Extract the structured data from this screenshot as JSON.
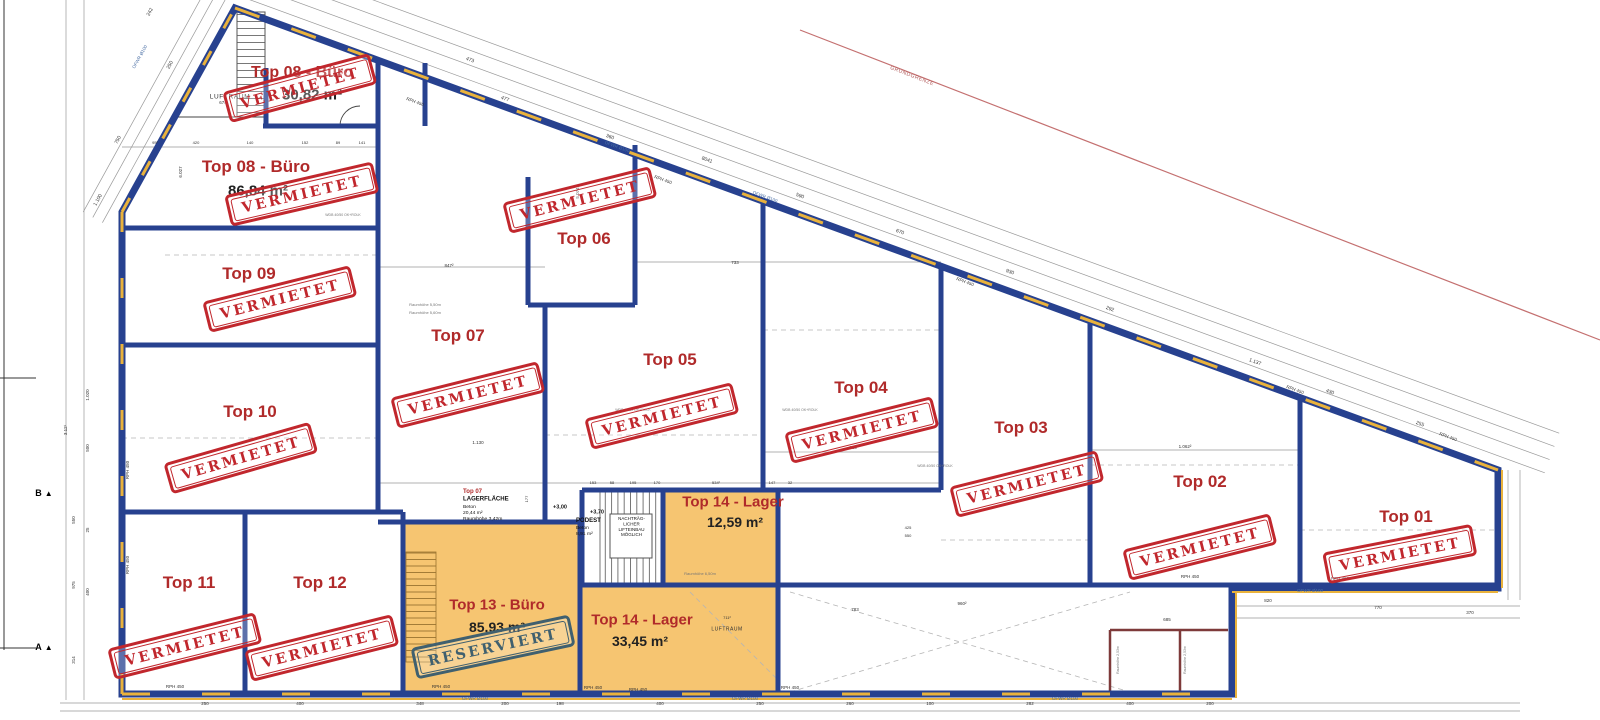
{
  "colors": {
    "wall_navy": "#27418f",
    "accent_gold": "#e9b23c",
    "highlight_orange": "#f6c571",
    "label_red": "#b02a2a",
    "stamp_red": "#c1272d",
    "stamp_slate": "#40606f",
    "boundary_red": "#c47070",
    "partition_maroon": "#7e3a3a"
  },
  "stamps": {
    "rented": "VERMIETET",
    "reserved": "RESERVIERT"
  },
  "units": {
    "top01": {
      "name": "Top 01",
      "status": "rented"
    },
    "top02": {
      "name": "Top 02",
      "status": "rented"
    },
    "top03": {
      "name": "Top 03",
      "status": "rented"
    },
    "top04": {
      "name": "Top 04",
      "status": "rented"
    },
    "top05": {
      "name": "Top 05",
      "status": "rented"
    },
    "top06": {
      "name": "Top 06",
      "status": "rented"
    },
    "top07": {
      "name": "Top 07",
      "status": "rented"
    },
    "top08_upper": {
      "name": "Top 08 - Büro",
      "area": "30,82 m²",
      "status": "rented"
    },
    "top08_lower": {
      "name": "Top 08 - Büro",
      "area": "86,84 m²",
      "status": "rented"
    },
    "top09": {
      "name": "Top 09",
      "status": "rented"
    },
    "top10": {
      "name": "Top 10",
      "status": "rented"
    },
    "top11": {
      "name": "Top 11",
      "status": "rented"
    },
    "top12": {
      "name": "Top 12",
      "status": "rented"
    },
    "top13": {
      "name": "Top 13 - Büro",
      "area": "85,93 m²",
      "status": "reserved"
    },
    "top14_upper": {
      "name": "Top 14 - Lager",
      "area": "12,59 m²",
      "status": ""
    },
    "top14_lower": {
      "name": "Top 14 - Lager",
      "area": "33,45 m²",
      "status": ""
    }
  },
  "annotations": {
    "luftraum": "LUFTRAUM",
    "storage_block": {
      "unit": "Top 07",
      "title": "LAGERFLÄCHE",
      "material": "Beton",
      "area": "20,44 m²",
      "room_height": "Raumhöhe 3,42m"
    },
    "podest_block": {
      "title": "PODEST",
      "material": "Beton",
      "area": "8,91 m²"
    },
    "lift_note_lines": [
      "NACHTRÄG-",
      "LICHER",
      "LIFTEINBAU",
      "MÖGLICH"
    ],
    "boundary_label": "GRUNDGRENZE",
    "section_markers": {
      "a": "A",
      "b": "B"
    },
    "levels": {
      "lower": "+3,00",
      "upper": "+3,70"
    }
  },
  "tiny_labels": [
    {
      "t": "473",
      "x": 470,
      "y": 60,
      "r": 20,
      "s": 5
    },
    {
      "t": "477",
      "x": 505,
      "y": 99,
      "r": 20,
      "s": 5
    },
    {
      "t": "360",
      "x": 610,
      "y": 137,
      "r": 20,
      "s": 5
    },
    {
      "t": "8041",
      "x": 707,
      "y": 160,
      "r": 20,
      "s": 5
    },
    {
      "t": "590",
      "x": 800,
      "y": 196,
      "r": 20,
      "s": 5
    },
    {
      "t": "670",
      "x": 900,
      "y": 232,
      "r": 20,
      "s": 5
    },
    {
      "t": "930",
      "x": 1010,
      "y": 272,
      "r": 20,
      "s": 5
    },
    {
      "t": "292",
      "x": 1110,
      "y": 309,
      "r": 20,
      "s": 5
    },
    {
      "t": "1.137",
      "x": 1255,
      "y": 362,
      "r": 20,
      "s": 5
    },
    {
      "t": "430",
      "x": 1330,
      "y": 392,
      "r": 20,
      "s": 5
    },
    {
      "t": "255",
      "x": 1420,
      "y": 424,
      "r": 20,
      "s": 5
    },
    {
      "t": "1.100",
      "x": 98,
      "y": 200,
      "r": -61,
      "s": 5
    },
    {
      "t": "750",
      "x": 118,
      "y": 140,
      "r": -61,
      "s": 5
    },
    {
      "t": "250",
      "x": 170,
      "y": 65,
      "r": -61,
      "s": 5
    },
    {
      "t": "242",
      "x": 150,
      "y": 12,
      "r": -61,
      "s": 5
    },
    {
      "t": "RPH 450",
      "x": 415,
      "y": 102,
      "r": 20,
      "s": 4.5
    },
    {
      "t": "RPH 450",
      "x": 663,
      "y": 180,
      "r": 20,
      "s": 4.5
    },
    {
      "t": "RPH 450",
      "x": 965,
      "y": 282,
      "r": 20,
      "s": 4.5
    },
    {
      "t": "RPH 450",
      "x": 1295,
      "y": 390,
      "r": 20,
      "s": 4.5
    },
    {
      "t": "RPH 450",
      "x": 1448,
      "y": 437,
      "r": 20,
      "s": 4.5
    },
    {
      "t": "RPH 450",
      "x": 128,
      "y": 470,
      "r": -90,
      "s": 4.5
    },
    {
      "t": "RPH 450",
      "x": 128,
      "y": 565,
      "r": -90,
      "s": 4.5
    },
    {
      "t": "RPH 450",
      "x": 175,
      "y": 687,
      "r": 0,
      "s": 4.5
    },
    {
      "t": "RPH 450",
      "x": 441,
      "y": 687,
      "r": 0,
      "s": 4.5
    },
    {
      "t": "RPH 450",
      "x": 593,
      "y": 688,
      "r": 0,
      "s": 4.5
    },
    {
      "t": "RPH 450",
      "x": 638,
      "y": 690,
      "r": 0,
      "s": 4.5
    },
    {
      "t": "RPH 450",
      "x": 790,
      "y": 688,
      "r": 0,
      "s": 4.5
    },
    {
      "t": "RPH 450",
      "x": 1190,
      "y": 577,
      "r": 0,
      "s": 4.5
    },
    {
      "t": "RPH 450",
      "x": 1340,
      "y": 579,
      "r": 0,
      "s": 4.5
    },
    {
      "t": "OFWR Ø100",
      "x": 475,
      "y": 699,
      "r": 0,
      "s": 4.5,
      "c": "blue"
    },
    {
      "t": "OFWR Ø100",
      "x": 745,
      "y": 699,
      "r": 0,
      "s": 4.5,
      "c": "blue"
    },
    {
      "t": "OFWR Ø100",
      "x": 1065,
      "y": 699,
      "r": 0,
      "s": 4.5,
      "c": "blue"
    },
    {
      "t": "OFWR Ø100",
      "x": 1310,
      "y": 591,
      "r": 0,
      "s": 4.5,
      "c": "blue"
    },
    {
      "t": "OFWR Ø100",
      "x": 140,
      "y": 57,
      "r": -61,
      "s": 4.5,
      "c": "blue"
    },
    {
      "t": "OFWR Ø100",
      "x": 617,
      "y": 147,
      "r": 20,
      "s": 4.5,
      "c": "blue"
    },
    {
      "t": "OFWR Ø100",
      "x": 765,
      "y": 197,
      "r": 20,
      "s": 4.5,
      "c": "blue"
    },
    {
      "t": "95²",
      "x": 155,
      "y": 143,
      "r": 0,
      "s": 4
    },
    {
      "t": "420",
      "x": 196,
      "y": 143,
      "r": 0,
      "s": 4
    },
    {
      "t": "140",
      "x": 250,
      "y": 143,
      "r": 0,
      "s": 4
    },
    {
      "t": "152",
      "x": 305,
      "y": 143,
      "r": 0,
      "s": 4
    },
    {
      "t": "89",
      "x": 338,
      "y": 143,
      "r": 0,
      "s": 4
    },
    {
      "t": "141",
      "x": 362,
      "y": 143,
      "r": 0,
      "s": 4
    },
    {
      "t": "153",
      "x": 593,
      "y": 483,
      "r": 0,
      "s": 4
    },
    {
      "t": "58",
      "x": 612,
      "y": 483,
      "r": 0,
      "s": 4
    },
    {
      "t": "195",
      "x": 633,
      "y": 483,
      "r": 0,
      "s": 4
    },
    {
      "t": "170",
      "x": 657,
      "y": 483,
      "r": 0,
      "s": 4
    },
    {
      "t": "534²",
      "x": 716,
      "y": 483,
      "r": 0,
      "s": 4
    },
    {
      "t": "147",
      "x": 772,
      "y": 483,
      "r": 0,
      "s": 4
    },
    {
      "t": "32",
      "x": 790,
      "y": 483,
      "r": 0,
      "s": 4
    },
    {
      "t": "674",
      "x": 223,
      "y": 103,
      "r": 0,
      "s": 4.5
    },
    {
      "t": "847²",
      "x": 449,
      "y": 266,
      "r": 0,
      "s": 4.5
    },
    {
      "t": "733",
      "x": 735,
      "y": 263,
      "r": 0,
      "s": 4.5
    },
    {
      "t": "5.074",
      "x": 578,
      "y": 193,
      "r": -90,
      "s": 4.5
    },
    {
      "t": "6.027",
      "x": 181,
      "y": 172,
      "r": -90,
      "s": 4.5
    },
    {
      "t": "1.130",
      "x": 478,
      "y": 443,
      "r": 0,
      "s": 4.5
    },
    {
      "t": "1.062²",
      "x": 1185,
      "y": 447,
      "r": 0,
      "s": 4.5
    },
    {
      "t": "960",
      "x": 853,
      "y": 448,
      "r": 0,
      "s": 4.5
    },
    {
      "t": "685",
      "x": 1167,
      "y": 620,
      "r": 0,
      "s": 4.5
    },
    {
      "t": "783",
      "x": 855,
      "y": 610,
      "r": 0,
      "s": 4.5
    },
    {
      "t": "960²",
      "x": 962,
      "y": 604,
      "r": 0,
      "s": 4.5
    },
    {
      "t": "711²",
      "x": 727,
      "y": 618,
      "r": 0,
      "s": 4
    },
    {
      "t": "425",
      "x": 908,
      "y": 528,
      "r": 0,
      "s": 4
    },
    {
      "t": "550",
      "x": 908,
      "y": 536,
      "r": 0,
      "s": 4
    },
    {
      "t": "177",
      "x": 527,
      "y": 499,
      "r": -90,
      "s": 4
    },
    {
      "t": "250",
      "x": 205,
      "y": 704,
      "r": 0,
      "s": 4.5
    },
    {
      "t": "400",
      "x": 300,
      "y": 704,
      "r": 0,
      "s": 4.5
    },
    {
      "t": "348",
      "x": 420,
      "y": 704,
      "r": 0,
      "s": 4.5
    },
    {
      "t": "200",
      "x": 505,
      "y": 704,
      "r": 0,
      "s": 4.5
    },
    {
      "t": "198",
      "x": 560,
      "y": 704,
      "r": 0,
      "s": 4.5
    },
    {
      "t": "400",
      "x": 660,
      "y": 704,
      "r": 0,
      "s": 4.5
    },
    {
      "t": "250",
      "x": 760,
      "y": 704,
      "r": 0,
      "s": 4.5
    },
    {
      "t": "260",
      "x": 850,
      "y": 704,
      "r": 0,
      "s": 4.5
    },
    {
      "t": "100",
      "x": 930,
      "y": 704,
      "r": 0,
      "s": 4.5
    },
    {
      "t": "282",
      "x": 1030,
      "y": 704,
      "r": 0,
      "s": 4.5
    },
    {
      "t": "400",
      "x": 1130,
      "y": 704,
      "r": 0,
      "s": 4.5
    },
    {
      "t": "200",
      "x": 1210,
      "y": 704,
      "r": 0,
      "s": 4.5
    },
    {
      "t": "820",
      "x": 1268,
      "y": 601,
      "r": 0,
      "s": 4.5
    },
    {
      "t": "770",
      "x": 1378,
      "y": 608,
      "r": 0,
      "s": 4.5
    },
    {
      "t": "370",
      "x": 1470,
      "y": 613,
      "r": 0,
      "s": 4.5
    },
    {
      "t": "500",
      "x": 88,
      "y": 448,
      "r": -90,
      "s": 4.5
    },
    {
      "t": "550",
      "x": 74,
      "y": 520,
      "r": -90,
      "s": 4.5
    },
    {
      "t": "25",
      "x": 88,
      "y": 530,
      "r": -90,
      "s": 4.5
    },
    {
      "t": "975",
      "x": 74,
      "y": 585,
      "r": -90,
      "s": 4.5
    },
    {
      "t": "400",
      "x": 88,
      "y": 592,
      "r": -90,
      "s": 4.5
    },
    {
      "t": "314",
      "x": 74,
      "y": 660,
      "r": -90,
      "s": 4.5
    },
    {
      "t": "1.020",
      "x": 88,
      "y": 395,
      "r": -90,
      "s": 4.5
    },
    {
      "t": "3.12¹",
      "x": 66,
      "y": 430,
      "r": -90,
      "s": 4.5
    },
    {
      "t": "Raumhöhe 5,50m",
      "x": 425,
      "y": 305,
      "r": 0,
      "s": 4,
      "c": "gray"
    },
    {
      "t": "Raumhöhe 5,60m",
      "x": 425,
      "y": 313,
      "r": 0,
      "s": 4,
      "c": "gray"
    },
    {
      "t": "Raumhöhe 6,50m",
      "x": 700,
      "y": 574,
      "r": 0,
      "s": 4,
      "c": "gray"
    },
    {
      "t": "Raumhöhe 2,53m",
      "x": 1118,
      "y": 660,
      "r": -90,
      "s": 3.5,
      "c": "gray"
    },
    {
      "t": "Raumhöhe 2,53m",
      "x": 1185,
      "y": 660,
      "r": -90,
      "s": 3.5,
      "c": "gray"
    },
    {
      "t": "WDB 40/50 OK+ROLK",
      "x": 343,
      "y": 215,
      "r": 0,
      "s": 3.5,
      "c": "gray"
    },
    {
      "t": "WDB 40/50 OK+ROLK",
      "x": 633,
      "y": 410,
      "r": 0,
      "s": 3.5,
      "c": "gray"
    },
    {
      "t": "WDB 40/50 OK+ROLK",
      "x": 800,
      "y": 410,
      "r": 0,
      "s": 3.5,
      "c": "gray"
    },
    {
      "t": "WDB 40/50 OK+ROLK",
      "x": 935,
      "y": 466,
      "r": 0,
      "s": 3.5,
      "c": "gray"
    }
  ]
}
